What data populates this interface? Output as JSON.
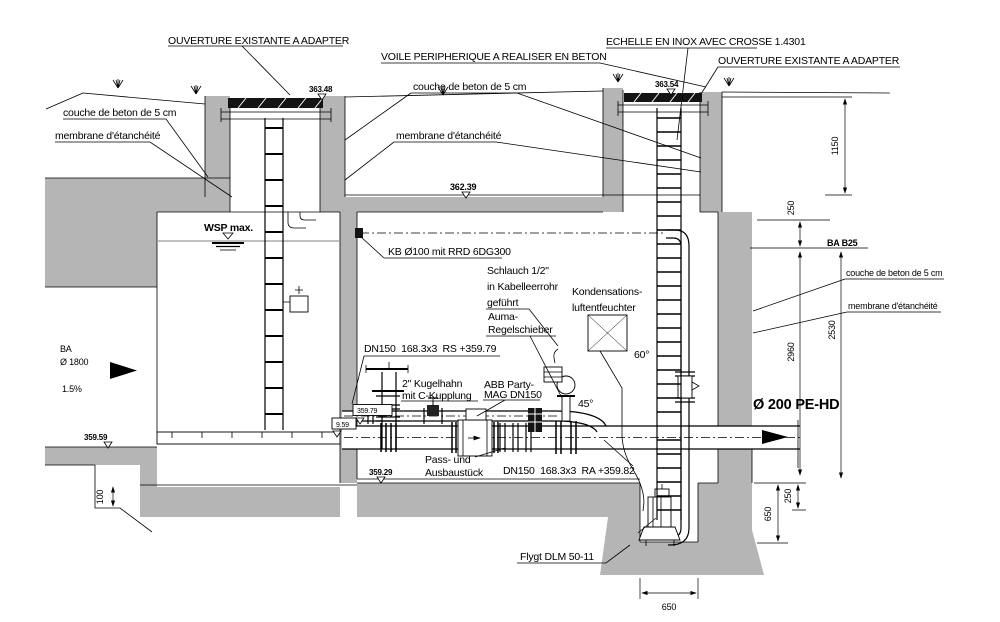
{
  "drawing": {
    "callouts": {
      "ouverture_left": "OUVERTURE EXISTANTE A ADAPTER",
      "voile": "VOILE PERIPHERIQUE A REALISER EN BETON",
      "echelle": "ECHELLE EN INOX AVEC CROSSE 1.4301",
      "ouverture_right": "OUVERTURE EXISTANTE A ADAPTER",
      "couche_left": "couche de beton de 5 cm",
      "membrane_left": "membrane d'étanchéité",
      "couche_mid": "couche de beton de 5 cm",
      "membrane_mid": "membrane d'étanchéité",
      "couche_right": "couche de beton de 5 cm",
      "membrane_right": "membrane d'étanchéité",
      "kb": "KB Ø100 mit RRD 6DG300",
      "schlauch_l1": "Schlauch 1/2\"",
      "schlauch_l2": "in Kabelleerrohr",
      "schlauch_l3": "geführt",
      "kondens_l1": "Kondensations-",
      "kondens_l2": "luftentfeuchter",
      "auma_l1": "Auma-",
      "auma_l2": "Regelschieber",
      "dn150_rs": "DN150  168.3x3  RS +359.79",
      "kugelhahn_l1": "2\" Kugelhahn",
      "kugelhahn_l2": "mit C-Kupplung",
      "abb_l1": "ABB Party-",
      "abb_l2": "MAG DN150",
      "pass_l1": "Pass- und",
      "pass_l2": "Ausbaustück",
      "dn150_ra": "DN150  168.3x3  RA +359.82",
      "flygt": "Flygt DLM 50-11",
      "wsp": "WSP max.",
      "ba_l1": "BA",
      "ba_l2": "Ø 1800",
      "slope": "1.5%",
      "ba_b25": "BA B25",
      "pe_hd": "Ø 200 PE-HD",
      "angle_45": "45°",
      "angle_60": "60°"
    },
    "elevations": {
      "top_left": "363.48",
      "top_right": "363.54",
      "upper_floor": "362.39",
      "pipe_rs": "359.79",
      "pipe_low": "9.59",
      "floor_mid": "359.29",
      "invert_left": "359.59"
    },
    "dimensions": {
      "h_1150": "1150",
      "t_250_top": "250",
      "h_2530": "2530",
      "h_2960": "2960",
      "t_250_bot": "250",
      "h_650_right": "650",
      "w_650_bottom": "650",
      "h_100": "100"
    },
    "colors": {
      "concrete": "#b5b5b5",
      "cover": "#141414",
      "line": "#000000"
    }
  }
}
